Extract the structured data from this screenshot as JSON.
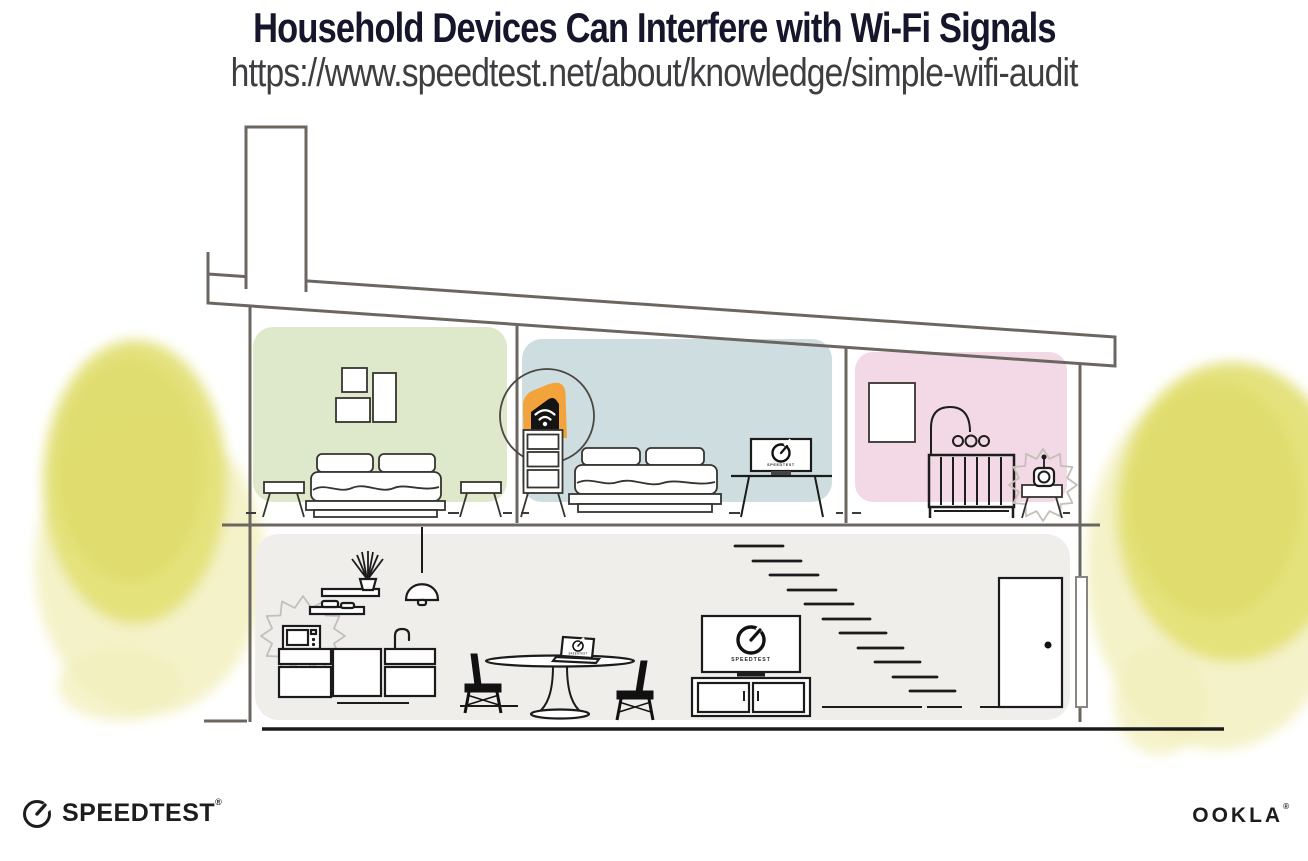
{
  "header": {
    "title": "Household Devices Can Interfere with Wi-Fi Signals",
    "url": "https://www.speedtest.net/about/knowledge/simple-wifi-audit"
  },
  "screens": {
    "tv_label": "SPEEDTEST",
    "monitor_label": "SPEEDTEST",
    "laptop_label": "SPEEDTEST"
  },
  "footer": {
    "speedtest_wordmark": "SPEEDTEST",
    "ookla_wordmark": "OOKLA",
    "reg_mark": "®"
  },
  "colors": {
    "title": "#15162B",
    "url_text": "#3E3E41",
    "accent_orange": "#F2A33B",
    "room_green": "#DEE8CB",
    "room_blue": "#CEDEE0",
    "room_pink": "#F3D8E5",
    "floor_gray": "#F0EEEB",
    "tree_yellow": "#E3E077",
    "tree_yellow_light": "#F2F0BE",
    "structure_gray": "#6B6660"
  }
}
